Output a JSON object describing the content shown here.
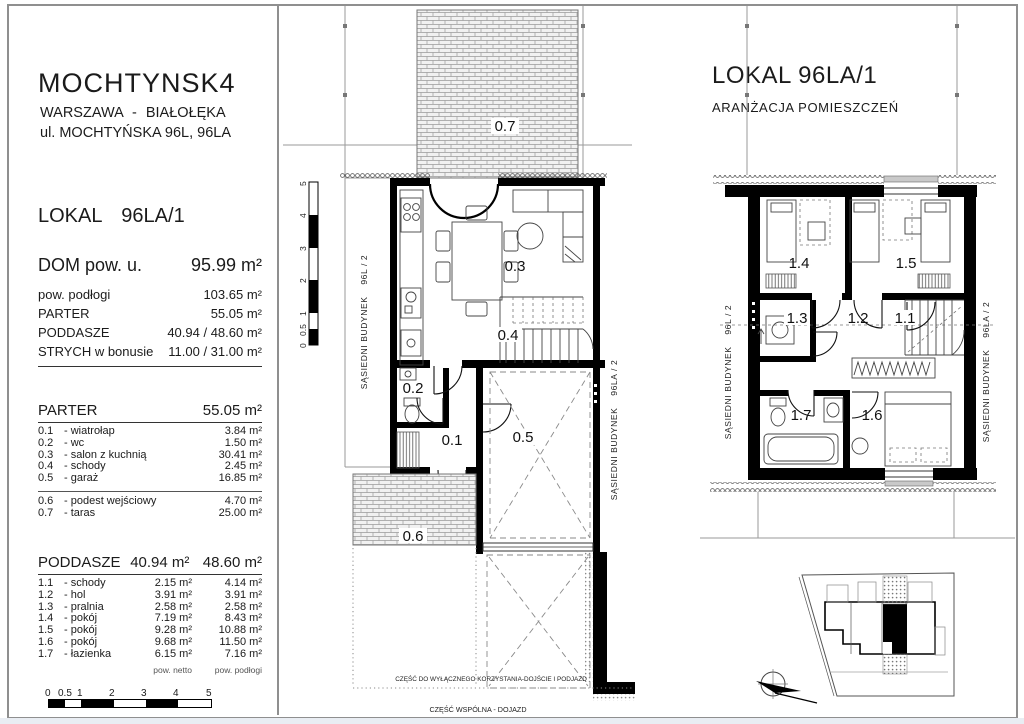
{
  "left_panel": {
    "project_title": "MOCHTYNSK4",
    "address1": "WARSZAWA - BIAŁOŁĘKA",
    "address2": "ul. MOCHTYŃSKA 96L, 96LA",
    "unit_title": "LOKAL 96LA/1",
    "summary": {
      "main_label": "DOM pow. u.",
      "main_value": "95.99 m²",
      "rows": [
        {
          "label": "pow. podłogi",
          "value": "103.65 m²"
        },
        {
          "label": "PARTER",
          "value": "55.05 m²"
        },
        {
          "label": "PODDASZE",
          "value": "40.94 / 48.60 m²"
        },
        {
          "label": "STRYCH w bonusie",
          "value": "11.00 / 31.00 m²"
        }
      ]
    },
    "parter": {
      "title": "PARTER",
      "area": "55.05 m²",
      "rows": [
        {
          "no": "0.1",
          "name": "- wiatrołap",
          "area": "3.84 m²"
        },
        {
          "no": "0.2",
          "name": "- wc",
          "area": "1.50 m²"
        },
        {
          "no": "0.3",
          "name": "- salon z kuchnią",
          "area": "30.41 m²"
        },
        {
          "no": "0.4",
          "name": "- schody",
          "area": "2.45 m²"
        },
        {
          "no": "0.5",
          "name": "- garaż",
          "area": "16.85 m²"
        }
      ],
      "extra": [
        {
          "no": "0.6",
          "name": "- podest wejściowy",
          "area": "4.70 m²"
        },
        {
          "no": "0.7",
          "name": "- taras",
          "area": "25.00 m²"
        }
      ]
    },
    "poddasze": {
      "title": "PODDASZE",
      "netto": "40.94 m²",
      "podlogi": "48.60 m²",
      "rows": [
        {
          "no": "1.1",
          "name": "- schody",
          "netto": "2.15 m²",
          "podlogi": "4.14 m²"
        },
        {
          "no": "1.2",
          "name": "- hol",
          "netto": "3.91 m²",
          "podlogi": "3.91 m²"
        },
        {
          "no": "1.3",
          "name": "- pralnia",
          "netto": "2.58 m²",
          "podlogi": "2.58 m²"
        },
        {
          "no": "1.4",
          "name": "- pokój",
          "netto": "7.19 m²",
          "podlogi": "8.43 m²"
        },
        {
          "no": "1.5",
          "name": "- pokój",
          "netto": "9.28 m²",
          "podlogi": "10.88 m²"
        },
        {
          "no": "1.6",
          "name": "- pokój",
          "netto": "9.68 m²",
          "podlogi": "11.50 m²"
        },
        {
          "no": "1.7",
          "name": "- łazienka",
          "netto": "6.15 m²",
          "podlogi": "7.16 m²"
        }
      ],
      "note_netto": "pow. netto",
      "note_podlogi": "pow. podłogi"
    }
  },
  "scale": {
    "labels": [
      "0",
      "0.5",
      "1",
      "2",
      "3",
      "4",
      "5"
    ]
  },
  "right_header": {
    "title": "LOKAL 96LA/1",
    "subtitle": "ARANŻACJA POMIESZCZEŃ"
  },
  "plan_parter": {
    "rooms": {
      "wiatrolap": "0.1",
      "wc": "0.2",
      "salon": "0.3",
      "schody": "0.4",
      "garaz": "0.5",
      "podest": "0.6",
      "taras": "0.7"
    },
    "neighbor_left": "SĄSIEDNI BUDYNEK    96L / 2",
    "neighbor_right": "SĄSIEDNI BUDYNEK    96LA / 2",
    "note_exclusive": "CZĘŚĆ DO WYŁĄCZNEGO KORZYSTANIA-DOJŚCIE I PODJAZD",
    "note_common": "CZĘŚĆ WSPÓLNA - DOJAZD"
  },
  "plan_poddasze": {
    "rooms": {
      "schody": "1.1",
      "hol": "1.2",
      "pralnia": "1.3",
      "pokoj_14": "1.4",
      "pokoj_15": "1.5",
      "pokoj_16": "1.6",
      "lazienka": "1.7"
    },
    "neighbor_left": "SĄSIEDNI BUDYNEK    96L / 2",
    "neighbor_right": "SĄSIEDNI BUDYNEK    96LA / 2"
  }
}
